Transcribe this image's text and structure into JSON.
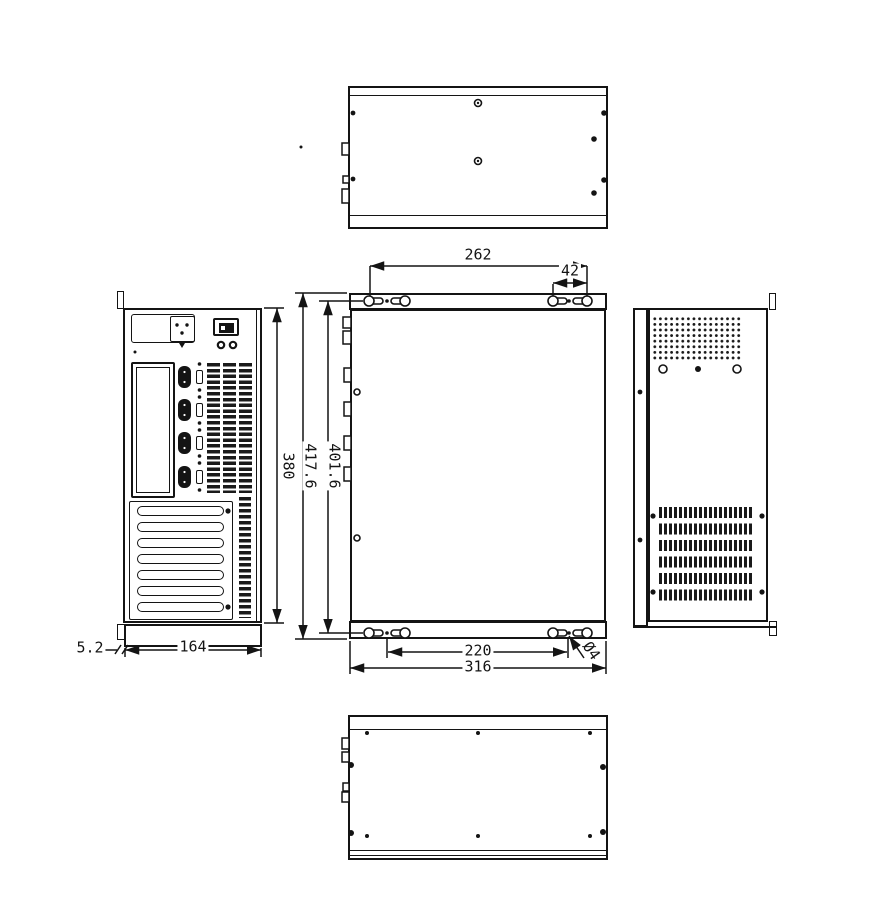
{
  "sheet": {
    "background": "#ffffff",
    "line_color": "#141414"
  },
  "dimensions": {
    "keyhole_span_horizontal": "262",
    "keyhole_pair_spacing": "42",
    "chassis_height": "380",
    "overall_height_with_brackets": "417.6",
    "keyhole_span_vertical": "401.6",
    "bracket_offset": "5.2",
    "chassis_depth": "164",
    "pilot_hole_span": "220",
    "overall_width": "316",
    "pilot_hole_diameter": "Ø4"
  }
}
